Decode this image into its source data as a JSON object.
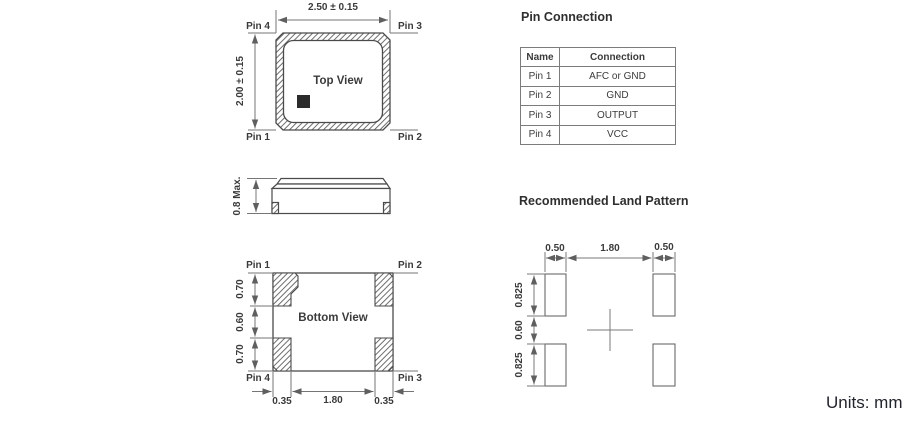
{
  "units_label": "Units: mm",
  "top_view": {
    "label": "Top View",
    "dim_width": "2.50 ± 0.15",
    "dim_height": "2.00 ± 0.15",
    "pin_top_left": "Pin 4",
    "pin_top_right": "Pin 3",
    "pin_bottom_left": "Pin 1",
    "pin_bottom_right": "Pin 2"
  },
  "side_view": {
    "dim_height": "0.8 Max."
  },
  "bottom_view": {
    "label": "Bottom View",
    "pin_top_left": "Pin 1",
    "pin_top_right": "Pin 2",
    "pin_bottom_left": "Pin 4",
    "pin_bottom_right": "Pin 3",
    "dims_left": [
      "0.70",
      "0.60",
      "0.70"
    ],
    "dims_bottom": [
      "0.35",
      "1.80",
      "0.35"
    ]
  },
  "pin_table": {
    "title": "Pin Connection",
    "headers": [
      "Name",
      "Connection"
    ],
    "rows": [
      [
        "Pin 1",
        "AFC or GND"
      ],
      [
        "Pin 2",
        "GND"
      ],
      [
        "Pin 3",
        "OUTPUT"
      ],
      [
        "Pin 4",
        "VCC"
      ]
    ]
  },
  "land_pattern": {
    "title": "Recommended Land Pattern",
    "dims_top": [
      "0.50",
      "1.80",
      "0.50"
    ],
    "dims_left": [
      "0.825",
      "0.60",
      "0.825"
    ]
  },
  "colors": {
    "outline": "#4a4a4a",
    "dimension_line": "#757575",
    "label_text": "#3b3b3b",
    "pin1_marker": "#2b2b2b"
  }
}
